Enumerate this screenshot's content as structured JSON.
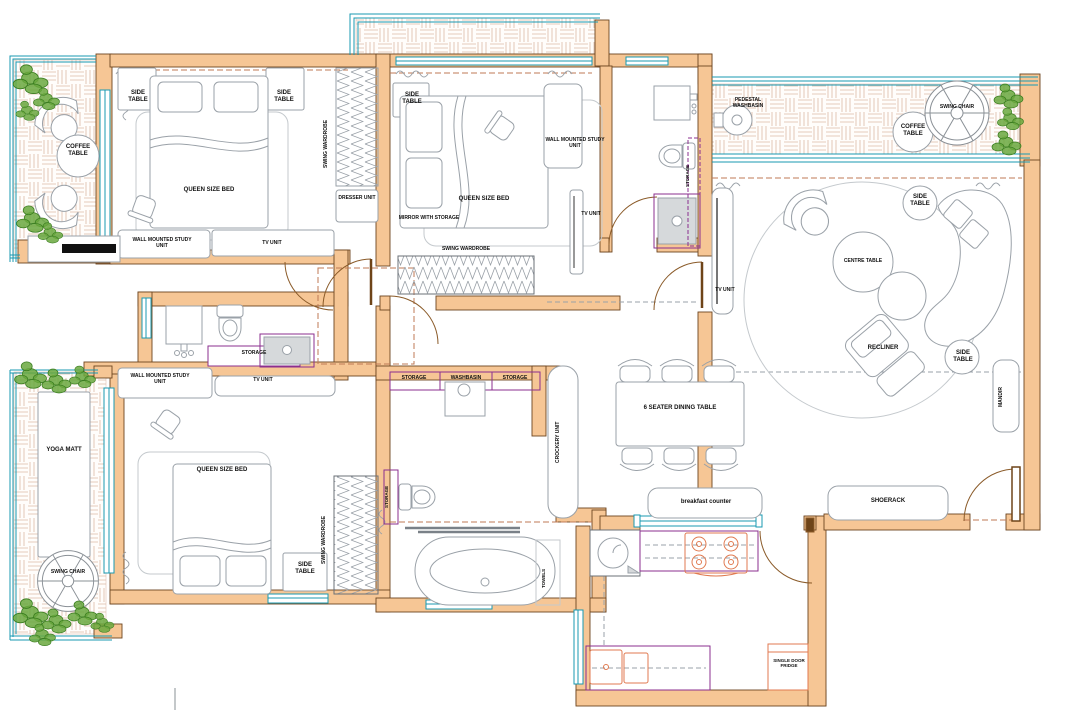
{
  "plan": {
    "balcony_top_left": {
      "coffee_table": "COFFEE TABLE"
    },
    "bedroom_top_left": {
      "side_table_left": "SIDE TABLE",
      "side_table_right": "SIDE TABLE",
      "bed": "QUEEN SIZE BED",
      "study_unit": "WALL MOUNTED STUDY UNIT",
      "tv_unit": "TV UNIT",
      "wardrobe": "SWING WARDROBE",
      "dresser": "DRESSER UNIT"
    },
    "bedroom_top_middle": {
      "side_table": "SIDE TABLE",
      "bed": "QUEEN SIZE BED",
      "study_unit": "WALL MOUNTED STUDY UNIT",
      "mirror": "MIRROR WITH STORAGE",
      "wardrobe": "SWING WARDROBE",
      "tv_unit": "TV UNIT"
    },
    "bathroom_top": {
      "storage": "STORAGE"
    },
    "balcony_top_right": {
      "washbasin": "PEDESTAL WASHBASIN",
      "coffee_table": "COFFEE TABLE",
      "swing_chair": "SWING CHAIR"
    },
    "living_room": {
      "tv_unit": "TV UNIT",
      "side_table_top": "SIDE TABLE",
      "centre_table": "CENTRE TABLE",
      "recliner": "RECLINER",
      "side_table_bottom": "SIDE TABLE",
      "mandir": "MANDIR",
      "shoerack": "SHOERACK"
    },
    "bathroom_middle": {
      "storage": "STORAGE"
    },
    "bedroom_bottom_left": {
      "study_unit": "WALL MOUNTED STUDY UNIT",
      "tv_unit": "TV UNIT",
      "bed": "QUEEN SIZE BED",
      "side_table": "SIDE TABLE",
      "wardrobe": "SWING WARDROBE"
    },
    "balcony_bottom_left": {
      "yoga_matt": "YOGA MATT",
      "swing_chair": "SWING CHAIR"
    },
    "bathroom_bottom": {
      "storage_left": "STORAGE",
      "washbasin": "WASHBASIN",
      "storage_right": "STORAGE",
      "storage_side": "STORAGE",
      "towels": "TOWELS"
    },
    "dining_kitchen": {
      "dining_table": "6 SEATER DINING TABLE",
      "crockery_unit": "CROCKERY UNIT",
      "breakfast_counter": "breakfast counter",
      "fridge": "SINGLE DOOR FRIDGE"
    }
  },
  "palette": {
    "wall": "#f6c695",
    "wall_edge": "#6d4520",
    "window": "#1899b2",
    "door": "#8a5a28",
    "furniture": "#9aa1a8",
    "storage_accent": "#8b2f8f",
    "fixture_accent": "#e07a50",
    "plant": "#5f9e35",
    "deck_line": "#dcb9a6",
    "label": "#111111"
  }
}
